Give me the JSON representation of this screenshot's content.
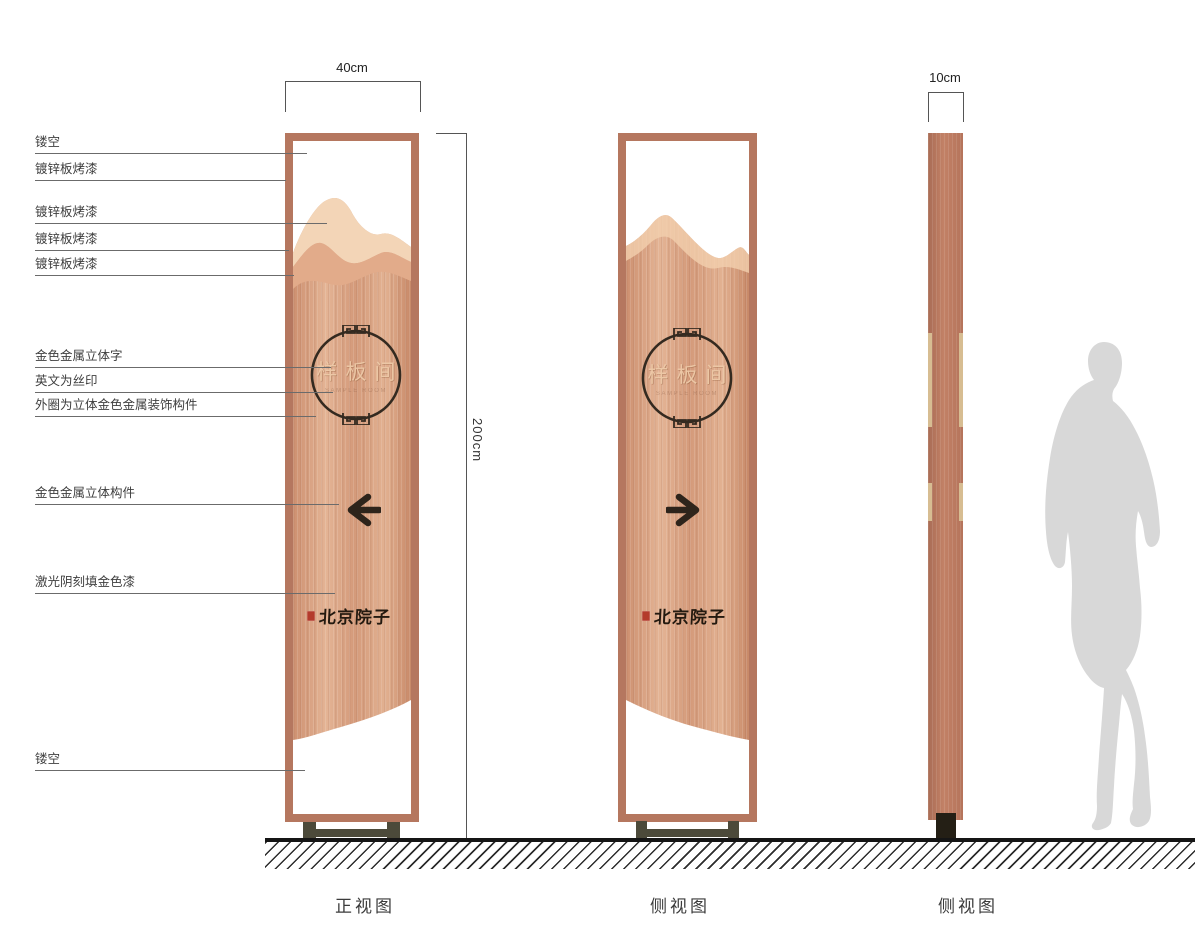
{
  "drawing": {
    "callouts": [
      {
        "text": "镂空"
      },
      {
        "text": "镀锌板烤漆"
      },
      {
        "text": "镀锌板烤漆"
      },
      {
        "text": "镀锌板烤漆"
      },
      {
        "text": "镀锌板烤漆"
      },
      {
        "text": "金色金属立体字"
      },
      {
        "text": "英文为丝印"
      },
      {
        "text": "外圈为立体金色金属装饰构件"
      },
      {
        "text": "金色金属立体构件"
      },
      {
        "text": "激光阴刻填金色漆"
      },
      {
        "text": "镂空"
      }
    ],
    "dimensions": {
      "front_width": "40cm",
      "total_height": "200cm",
      "side_depth": "10cm"
    },
    "sign": {
      "circle_label": "样板间",
      "circle_sublabel": "SAMPLE ROOM",
      "brand": "北京院子"
    },
    "captions": [
      {
        "label": "正视图"
      },
      {
        "label": "侧视图"
      },
      {
        "label": "侧视图"
      }
    ],
    "colors": {
      "frame": "#b5775f",
      "panel_copper": "#d49a7a",
      "mountain_light": "#f3d5b7",
      "mountain_mid": "#e2ab8a",
      "gold_strip": "#d7bd92",
      "arrow": "#2e241b",
      "seal_red": "#b43b2b",
      "base": "#4c4a3a",
      "ground": "#151515",
      "silhouette": "#d8d8d8"
    }
  }
}
